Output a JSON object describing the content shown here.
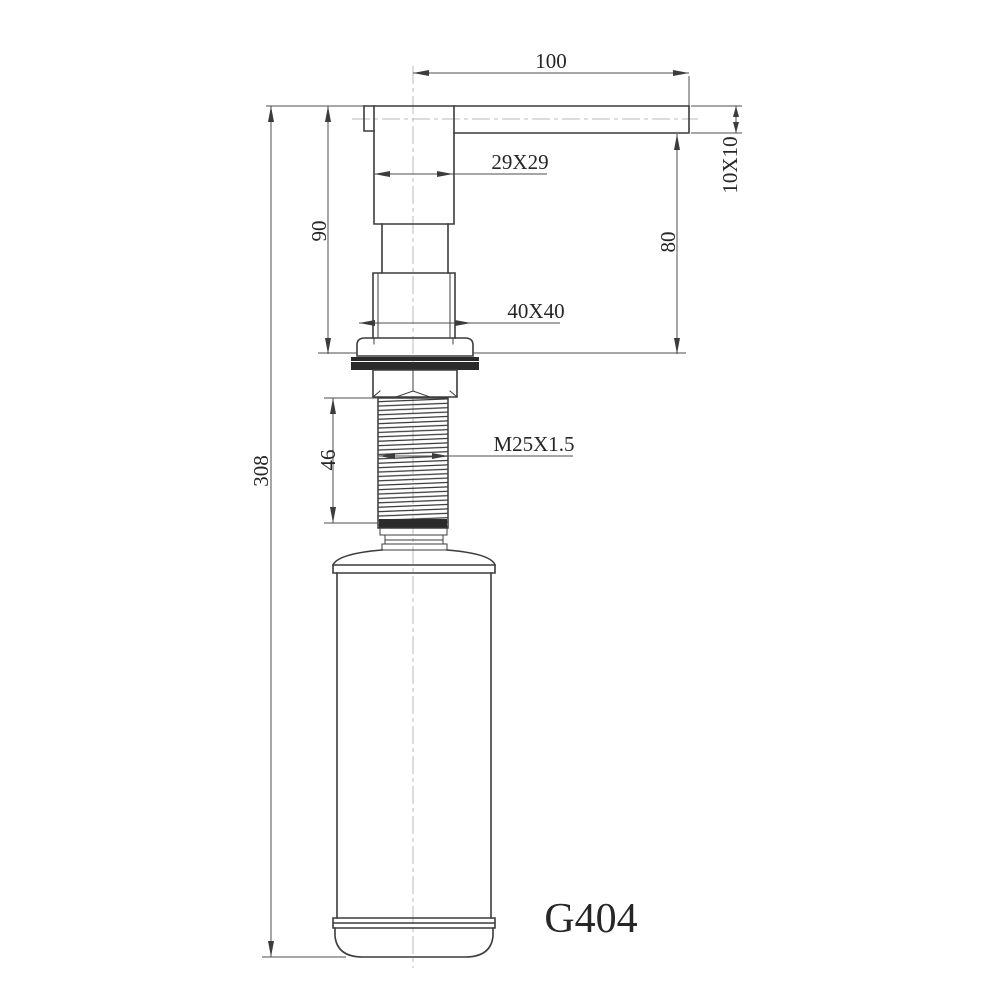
{
  "drawing": {
    "model": "G404",
    "type": "soap-dispenser technical drawing",
    "colors": {
      "outline": "#3c3c3c",
      "dimension_lines": "#4c4c4c",
      "centerline": "#b8b8b8",
      "gasket": "#2b2b2b",
      "background": "#ffffff"
    },
    "dimensions": {
      "spout_reach": "100",
      "head_section": "29X29",
      "spout_section": "10X10",
      "head_height": "90",
      "spout_underside_height": "80",
      "flange_section": "40X40",
      "thread_length": "46",
      "thread_spec": "M25X1.5",
      "total_height": "308"
    }
  }
}
